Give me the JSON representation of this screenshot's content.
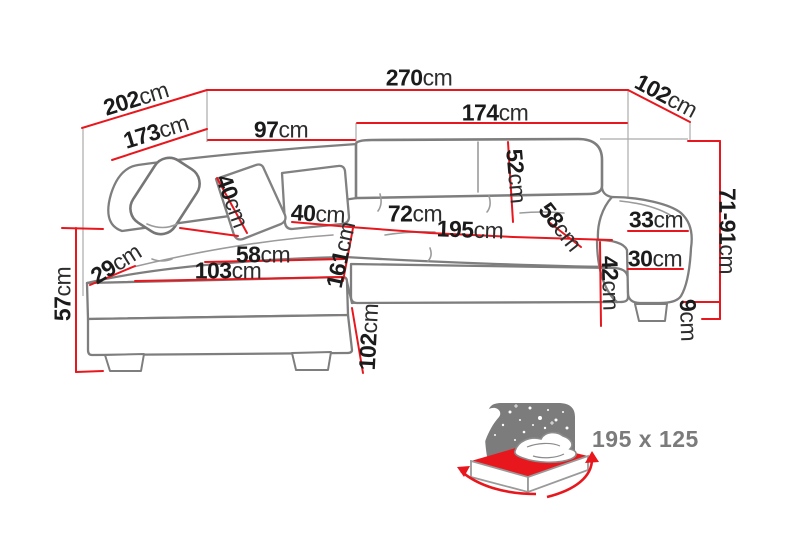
{
  "colors": {
    "accent_red": "#e8171d",
    "sofa_outline_grey": "#7e7e7e",
    "seam_grey": "#9b9b9b",
    "projection_grey": "#ababab",
    "label_text": "#1b1b1b",
    "headboard_grey": "#7c7c7c",
    "bed_label_grey": "#7b7b7b"
  },
  "dimensions": [
    {
      "id": "t270",
      "value": "270",
      "unit": "cm"
    },
    {
      "id": "t202",
      "value": "202",
      "unit": "cm"
    },
    {
      "id": "t102top",
      "value": "102",
      "unit": "cm"
    },
    {
      "id": "t173",
      "value": "173",
      "unit": "cm"
    },
    {
      "id": "t97",
      "value": "97",
      "unit": "cm"
    },
    {
      "id": "t174",
      "value": "174",
      "unit": "cm"
    },
    {
      "id": "t52",
      "value": "52",
      "unit": "cm"
    },
    {
      "id": "t40a",
      "value": "40",
      "unit": "cm"
    },
    {
      "id": "t40b",
      "value": "40",
      "unit": "cm"
    },
    {
      "id": "t72",
      "value": "72",
      "unit": "cm"
    },
    {
      "id": "t195",
      "value": "195",
      "unit": "cm"
    },
    {
      "id": "t58d",
      "value": "58",
      "unit": "cm"
    },
    {
      "id": "t33",
      "value": "33",
      "unit": "cm"
    },
    {
      "id": "t30",
      "value": "30",
      "unit": "cm"
    },
    {
      "id": "t42",
      "value": "42",
      "unit": "cm"
    },
    {
      "id": "t7191",
      "value": "71-91",
      "unit": "cm"
    },
    {
      "id": "t9",
      "value": "9",
      "unit": "cm"
    },
    {
      "id": "t57",
      "value": "57",
      "unit": "cm"
    },
    {
      "id": "t29",
      "value": "29",
      "unit": "cm"
    },
    {
      "id": "t58h",
      "value": "58",
      "unit": "cm"
    },
    {
      "id": "t103",
      "value": "103",
      "unit": "cm"
    },
    {
      "id": "t161",
      "value": "161",
      "unit": "cm"
    },
    {
      "id": "t102b",
      "value": "102",
      "unit": "cm"
    }
  ],
  "bed_icon": {
    "name": "sleeping-function-bed-icon",
    "size_label": "195 x 125"
  }
}
